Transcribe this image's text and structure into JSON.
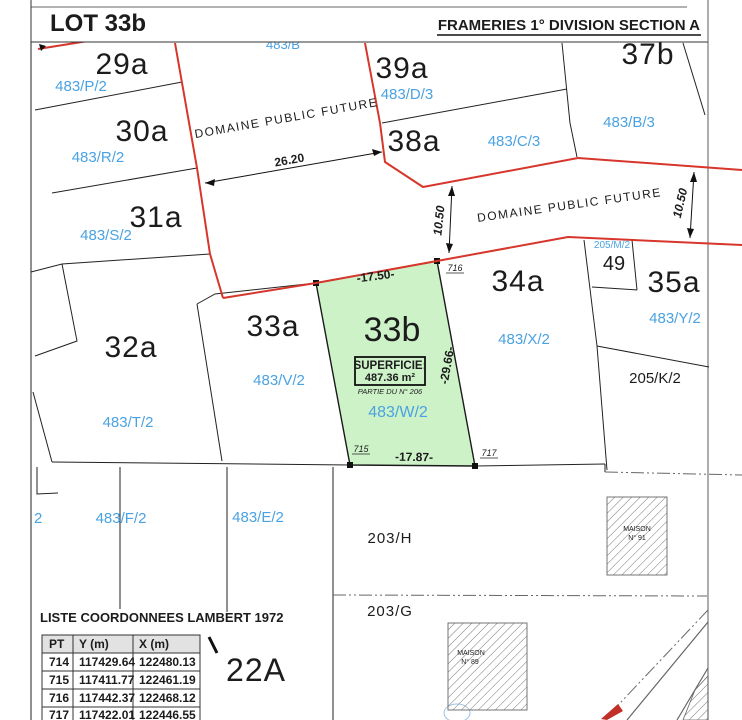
{
  "header": {
    "lot_title": "LOT 33b",
    "section_title": "FRAMERIES 1° DIVISION SECTION A"
  },
  "roads": {
    "domaine_public_1": "DOMAINE PUBLIC FUTURE",
    "domaine_public_2": "DOMAINE PUBLIC FUTURE"
  },
  "lot33b": {
    "name": "33b",
    "superficie_label": "SUPERFICIE:",
    "superficie_value": "487.36 m²",
    "partie_label": "PARTIE DU N° 206",
    "ref": "483/W/2",
    "point_top_right": "716",
    "point_bottom_left": "715",
    "point_bottom_right": "717"
  },
  "dimensions": {
    "front": "-17.50-",
    "side": "-29.66-",
    "back": "-17.87-",
    "corridor_width": "26.20",
    "corridor_depth_left": "10.50",
    "corridor_depth_right": "10.50"
  },
  "parcels": {
    "p29a": {
      "name": "29a",
      "ref": "483/P/2"
    },
    "p30a": {
      "name": "30a",
      "ref": "483/R/2"
    },
    "p31a": {
      "name": "31a",
      "ref": "483/S/2"
    },
    "p32a": {
      "name": "32a",
      "ref": "483/T/2"
    },
    "p33a": {
      "name": "33a",
      "ref": "483/V/2"
    },
    "p34a": {
      "name": "34a",
      "ref": "483/X/2"
    },
    "p35a": {
      "name": "35a",
      "ref": "483/Y/2"
    },
    "p37b": {
      "name": "37b",
      "ref": "483/B/3"
    },
    "p38a": {
      "name": "38a",
      "ref": "483/C/3"
    },
    "p39a": {
      "name": "39a",
      "ref": "483/D/3"
    },
    "p49": {
      "name": "49",
      "ref": "205/M/2"
    },
    "p22a": {
      "name": "22A"
    },
    "p205k": {
      "name": "205/K/2"
    },
    "p203h": {
      "name": "203/H"
    },
    "p203g": {
      "name": "203/G"
    },
    "p483f": {
      "name": "483/F/2"
    },
    "p483e": {
      "name": "483/E/2"
    },
    "partial_left": {
      "name": "2"
    },
    "partial_top": {
      "name": "483/B"
    }
  },
  "buildings": {
    "maison91": {
      "line1": "MAISON",
      "line2": "N° 91"
    },
    "maison89": {
      "line1": "MAISON",
      "line2": "N° 89"
    }
  },
  "coord_table": {
    "title": "LISTE COORDONNEES  LAMBERT 1972",
    "columns": [
      "PT",
      "Y (m)",
      "X (m)"
    ],
    "rows": [
      [
        "714",
        "117429.64",
        "122480.13"
      ],
      [
        "715",
        "117411.77",
        "122461.19"
      ],
      [
        "716",
        "117442.37",
        "122468.12"
      ],
      [
        "717",
        "117422.01",
        "122446.55"
      ]
    ]
  },
  "colors": {
    "boundary_red": "#d6362b",
    "label_blue": "#4aa2e2",
    "parcel_green_fill": "#cdf2c8"
  }
}
